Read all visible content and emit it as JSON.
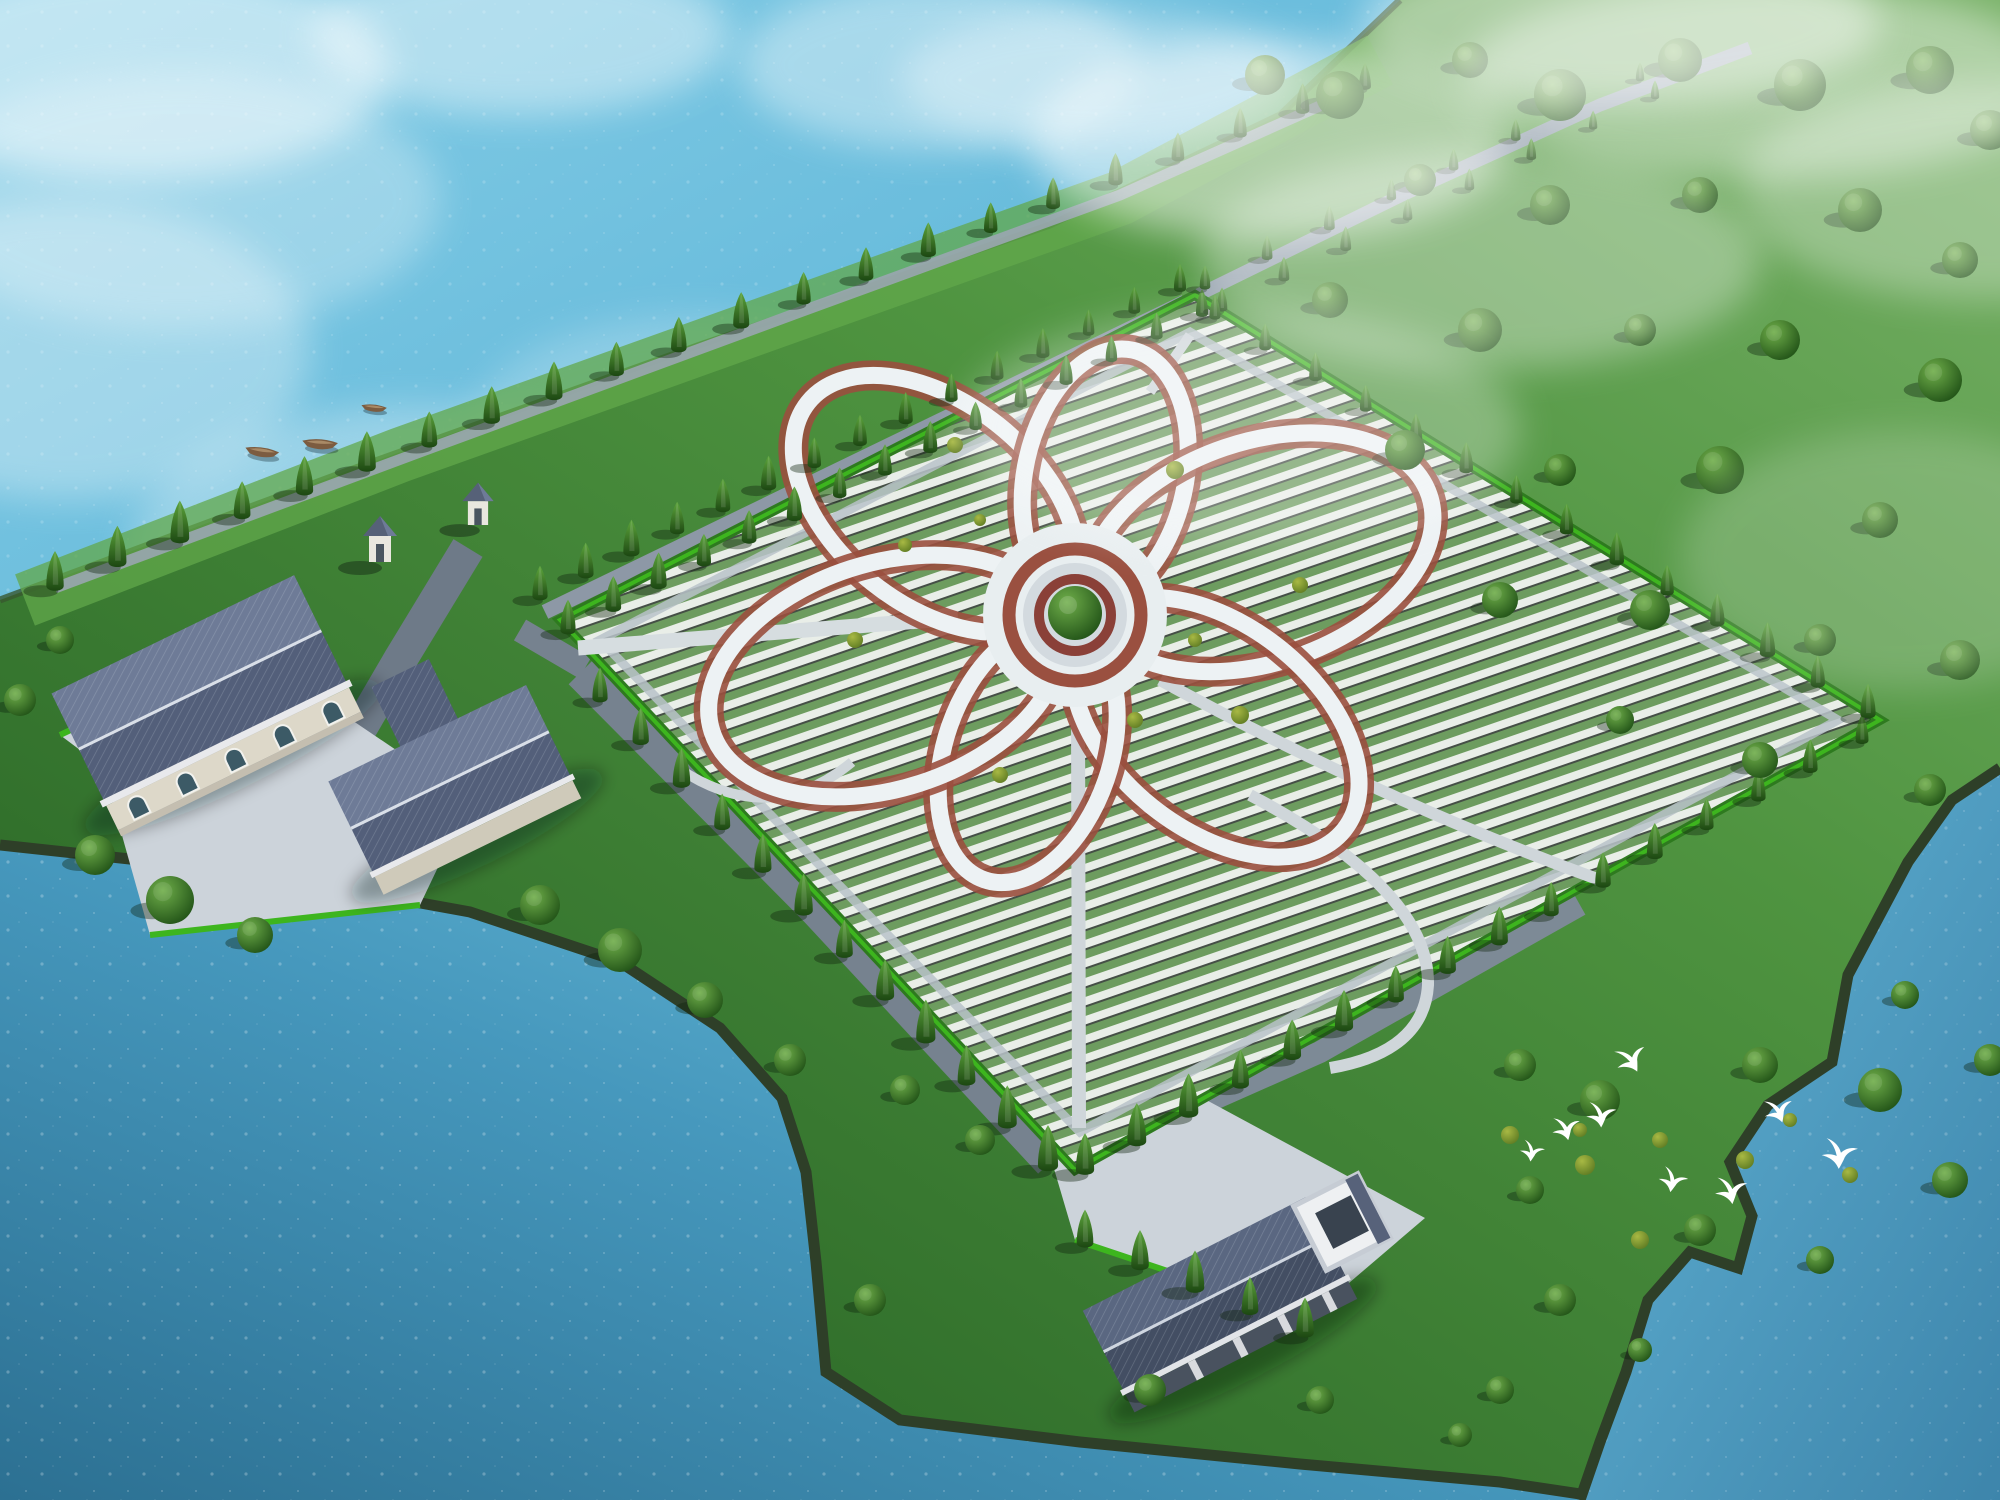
{
  "scene": {
    "title": "Aerial 3D rendering of a lakeside memorial-park master plan with a six-petal flower shaped walkway",
    "type": "architectural-visualization",
    "elements": [
      "lake water on the top-left, bottom-left and bottom-right",
      "large rhombus cemetery field with rows of grave plots",
      "white flower-shaped pedestrian loop with red trim and central tree roundabout",
      "tree lined avenue along the shore and field edges",
      "entrance complex with gray tiled roof halls, arched windows and two gate towers",
      "service building with courtyard near the bottom shore",
      "rolling green hills with scattered trees and mist on the upper right",
      "meadow with bushes and a flock of white egrets on the lower right",
      "small wooden boats near the upper-left shore"
    ]
  },
  "palette": {
    "water_light": "#79c6e2",
    "water_mid": "#55b0d4",
    "water_deep": "#2e7a9e",
    "water_right": "#55a8cc",
    "shore_dark": "#2e3f28",
    "grass_light": "#79b268",
    "grass_mid": "#4f9440",
    "grass_dark": "#2f6d2a",
    "hedge": "#3db51e",
    "hedge_dark": "#2e7a1f",
    "row_stone": "#e9eee8",
    "row_plant": "#6d9c5f",
    "row_slot": "#454f46",
    "path_white": "#edf2f4",
    "path_trim": "#9a4f3e",
    "path_gray": "#cfd6da",
    "road_gray": "#76828f",
    "road_light": "#93a0ac",
    "plaza": "#ccd3da",
    "roof_light": "#6e7b97",
    "roof_dark": "#535f7a",
    "roof_deep": "#434e63",
    "wall_cream": "#ddd8c9",
    "window_glass": "#3c5a66",
    "cypress_hi": "#5da53c",
    "cypress_lo": "#1c4712",
    "tree_hi": "#6fae4a",
    "tree_lo": "#1e4f15",
    "bush_hi": "#a8b944",
    "bush_lo": "#5d7a22",
    "bird_white": "#ffffff",
    "boat_brown": "#7c5c40"
  },
  "flower": {
    "cx": 1075,
    "cy": 615,
    "tips": [
      [
        830,
        420
      ],
      [
        1128,
        372
      ],
      [
        1400,
        505
      ],
      [
        1322,
        812
      ],
      [
        992,
        858
      ],
      [
        742,
        722
      ]
    ],
    "trim_width": 30,
    "walk_width": 17,
    "hub": {
      "r_outer": 88,
      "r_ring": 66,
      "r_plaza": 52,
      "r_inner": 36,
      "tree_r": 27
    }
  },
  "tree_rows": [
    {
      "name": "shore-row",
      "x1": 55,
      "y1": 588,
      "x2": 1365,
      "y2": 88,
      "n": 22,
      "s1": 1.15,
      "s2": 0.78
    },
    {
      "name": "avenue-left",
      "x1": 540,
      "y1": 598,
      "x2": 1180,
      "y2": 290,
      "n": 15,
      "s1": 1.0,
      "s2": 0.72
    },
    {
      "name": "avenue-right",
      "x1": 568,
      "y1": 632,
      "x2": 1202,
      "y2": 315,
      "n": 15,
      "s1": 1.0,
      "s2": 0.72
    },
    {
      "name": "avenue-ext-left",
      "x1": 1205,
      "y1": 288,
      "x2": 1640,
      "y2": 80,
      "n": 8,
      "s1": 0.7,
      "s2": 0.52
    },
    {
      "name": "avenue-ext-right",
      "x1": 1222,
      "y1": 310,
      "x2": 1655,
      "y2": 98,
      "n": 8,
      "s1": 0.7,
      "s2": 0.52
    },
    {
      "name": "southwest-road-row",
      "x1": 600,
      "y1": 700,
      "x2": 1048,
      "y2": 1168,
      "n": 12,
      "s1": 1.0,
      "s2": 1.2
    },
    {
      "name": "southeast-edge-row",
      "x1": 1085,
      "y1": 1172,
      "x2": 1862,
      "y2": 742,
      "n": 16,
      "s1": 1.2,
      "s2": 0.85
    },
    {
      "name": "northeast-edge-row",
      "x1": 1215,
      "y1": 318,
      "x2": 1868,
      "y2": 716,
      "n": 14,
      "s1": 0.72,
      "s2": 0.95
    },
    {
      "name": "bottom-plaza-row",
      "x1": 1085,
      "y1": 1245,
      "x2": 1305,
      "y2": 1335,
      "n": 5,
      "s1": 1.1,
      "s2": 1.1
    }
  ],
  "round_trees": [
    [
      1265,
      75,
      20
    ],
    [
      1340,
      95,
      24
    ],
    [
      1470,
      60,
      18
    ],
    [
      1560,
      95,
      26
    ],
    [
      1680,
      60,
      22
    ],
    [
      1800,
      85,
      26
    ],
    [
      1930,
      70,
      24
    ],
    [
      1990,
      130,
      20
    ],
    [
      1420,
      180,
      16
    ],
    [
      1550,
      205,
      20
    ],
    [
      1700,
      195,
      18
    ],
    [
      1860,
      210,
      22
    ],
    [
      1960,
      260,
      18
    ],
    [
      1330,
      300,
      18
    ],
    [
      1480,
      330,
      22
    ],
    [
      1640,
      330,
      16
    ],
    [
      1780,
      340,
      20
    ],
    [
      1940,
      380,
      22
    ],
    [
      1405,
      450,
      20
    ],
    [
      1560,
      470,
      16
    ],
    [
      1720,
      470,
      24
    ],
    [
      1880,
      520,
      18
    ],
    [
      1500,
      600,
      18
    ],
    [
      1650,
      610,
      20
    ],
    [
      1820,
      640,
      16
    ],
    [
      1960,
      660,
      20
    ],
    [
      1620,
      720,
      14
    ],
    [
      1760,
      760,
      18
    ],
    [
      1930,
      790,
      16
    ],
    [
      1520,
      1065,
      16
    ],
    [
      1600,
      1100,
      20
    ],
    [
      1760,
      1065,
      18
    ],
    [
      1880,
      1090,
      22
    ],
    [
      1950,
      1180,
      18
    ],
    [
      1530,
      1190,
      14
    ],
    [
      1700,
      1230,
      16
    ],
    [
      1820,
      1260,
      14
    ],
    [
      1560,
      1300,
      16
    ],
    [
      1640,
      1350,
      12
    ],
    [
      1500,
      1390,
      14
    ],
    [
      1905,
      995,
      14
    ],
    [
      1990,
      1060,
      16
    ],
    [
      95,
      855,
      20
    ],
    [
      170,
      900,
      24
    ],
    [
      255,
      935,
      18
    ],
    [
      540,
      905,
      20
    ],
    [
      620,
      950,
      22
    ],
    [
      705,
      1000,
      18
    ],
    [
      790,
      1060,
      16
    ],
    [
      60,
      640,
      14
    ],
    [
      20,
      700,
      16
    ],
    [
      905,
      1090,
      15
    ],
    [
      980,
      1140,
      15
    ],
    [
      870,
      1300,
      16
    ],
    [
      1150,
      1390,
      16
    ],
    [
      1320,
      1400,
      14
    ],
    [
      1460,
      1435,
      12
    ]
  ],
  "bushes": [
    [
      1510,
      1135,
      9
    ],
    [
      1585,
      1165,
      10
    ],
    [
      1660,
      1140,
      8
    ],
    [
      1745,
      1160,
      9
    ],
    [
      1640,
      1240,
      9
    ],
    [
      1580,
      1130,
      7
    ],
    [
      1850,
      1175,
      8
    ],
    [
      1790,
      1120,
      7
    ]
  ],
  "flower_bushes": [
    [
      955,
      445,
      8
    ],
    [
      1175,
      470,
      9
    ],
    [
      1300,
      585,
      8
    ],
    [
      1240,
      715,
      9
    ],
    [
      1000,
      775,
      8
    ],
    [
      855,
      640,
      8
    ],
    [
      905,
      545,
      7
    ],
    [
      1135,
      720,
      8
    ],
    [
      980,
      520,
      6
    ],
    [
      1195,
      640,
      7
    ]
  ],
  "birds": [
    [
      1622,
      1060,
      1.15,
      -20
    ],
    [
      1593,
      1112,
      1.05,
      5
    ],
    [
      1558,
      1127,
      1.0,
      -5
    ],
    [
      1526,
      1148,
      0.85,
      15
    ],
    [
      1770,
      1110,
      1.05,
      -12
    ],
    [
      1830,
      1150,
      1.25,
      8
    ],
    [
      1666,
      1176,
      1.0,
      18
    ],
    [
      1722,
      1188,
      1.15,
      0
    ]
  ],
  "boats": [
    [
      262,
      452,
      1.0,
      8
    ],
    [
      320,
      444,
      1.05,
      4
    ],
    [
      374,
      408,
      0.75,
      6
    ]
  ],
  "water_clouds": [
    [
      140,
      70,
      250,
      110,
      0.5
    ],
    [
      520,
      35,
      210,
      80,
      0.42
    ],
    [
      940,
      65,
      200,
      85,
      0.38
    ],
    [
      70,
      350,
      240,
      150,
      0.32
    ],
    [
      420,
      555,
      290,
      150,
      0.3
    ],
    [
      700,
      430,
      230,
      115,
      0.22
    ],
    [
      180,
      200,
      260,
      130,
      0.28
    ]
  ],
  "mist": [
    [
      1270,
      140,
      240,
      100,
      0.5
    ],
    [
      1480,
      260,
      280,
      110,
      0.33
    ],
    [
      1240,
      430,
      280,
      120,
      0.28
    ],
    [
      1760,
      80,
      300,
      100,
      0.42
    ],
    [
      1980,
      190,
      240,
      110,
      0.3
    ],
    [
      1620,
      25,
      260,
      80,
      0.45
    ],
    [
      1900,
      560,
      220,
      130,
      0.18
    ],
    [
      1100,
      80,
      200,
      70,
      0.35
    ]
  ]
}
